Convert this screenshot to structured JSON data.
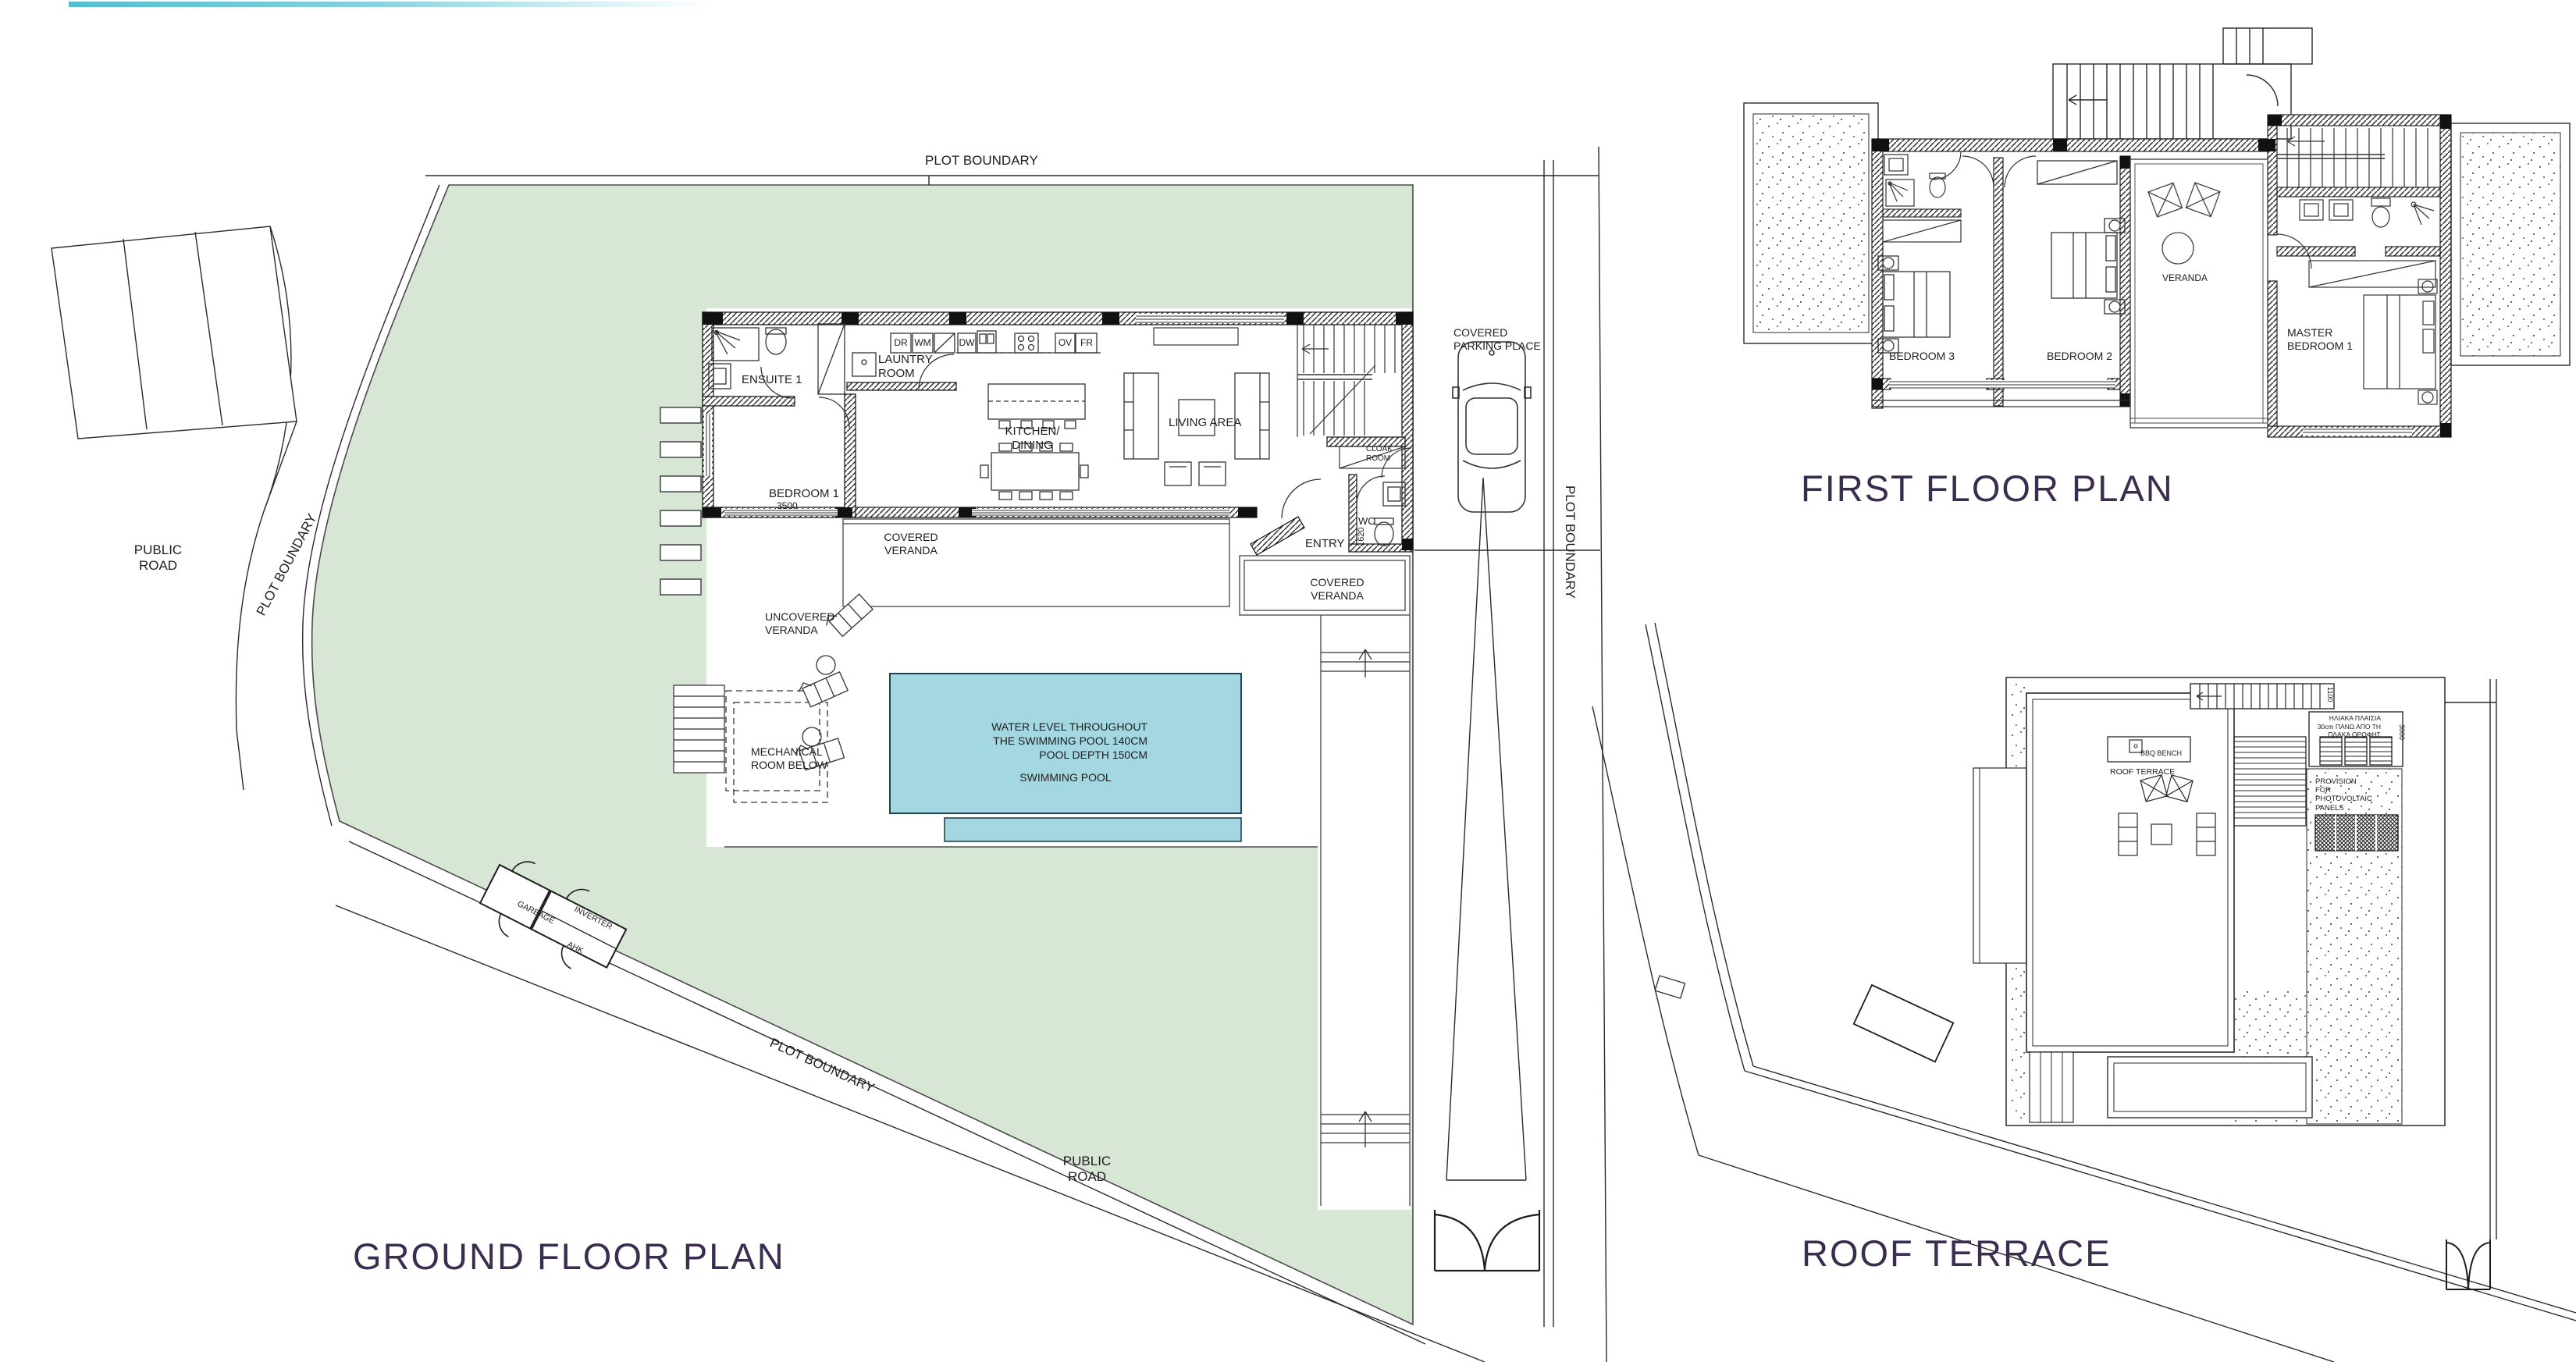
{
  "top_bar": {
    "color": "#54bfd0"
  },
  "titles": {
    "ground_floor": "GROUND FLOOR PLAN",
    "first_floor": "FIRST FLOOR PLAN",
    "roof_terrace": "ROOF TERRACE"
  },
  "site": {
    "plot_boundary": "PLOT BOUNDARY",
    "public_road": "PUBLIC ROAD"
  },
  "ground_floor": {
    "rooms": {
      "ensuite": "ENSUITE 1",
      "laundry": "LAUNTRY ROOM",
      "bedroom1": "BEDROOM 1",
      "bedroom1_dim": "3500",
      "kitchen_dining": "KITCHEN/ DINING",
      "living_area": "LIVING AREA",
      "cloak_room": "CLOAK ROOM",
      "wc": "WC",
      "wc_dim": "1620",
      "entry": "ENTRY",
      "covered_veranda": "COVERED VERANDA",
      "uncovered_veranda": "UNCOVERED VERANDA",
      "mechanical_room": "MECHANICAL ROOM BELOW",
      "covered_parking": "COVERED PARKING PLACE"
    },
    "appliances": {
      "dryer": "DR",
      "washing_machine": "WM",
      "dishwasher": "DW",
      "oven": "OV",
      "fridge": "FR"
    },
    "pool": {
      "note_line1": "WATER LEVEL THROUGHOUT",
      "note_line2": "THE SWIMMING POOL 140CM",
      "note_line3": "POOL DEPTH 150CM",
      "label": "SWIMMING POOL",
      "color": "#a3d7e2"
    },
    "outbuilding": {
      "garbage": "GARBAGE",
      "inverter": "INVERTER",
      "ahu": "AHK"
    }
  },
  "first_floor": {
    "rooms": {
      "bedroom3": "BEDROOM 3",
      "bedroom2": "BEDROOM 2",
      "veranda": "VERANDA",
      "master_bedroom": "MASTER BEDROOM 1"
    }
  },
  "roof_terrace": {
    "labels": {
      "bbq_bench": "BBQ BENCH",
      "roof_terrace": "ROOF TERRACE",
      "pv_provision": "PROVISION FOR PHOTOVOLTAIC PANELS"
    },
    "greek_note": {
      "line1": "ΗΛΙΑΚΑ ΠΛΑΙΣΙΑ",
      "line2": "30cm ΠΑΝΩ ΑΠΟ ΤΗ",
      "line3": "ΠΛΑΚΑ ΟΡΟΦΗΣ"
    },
    "dimensions": {
      "stair_width": "1100",
      "solar_height": "3000"
    }
  },
  "colors": {
    "plot_green": "#d7e6d5",
    "pool_blue": "#a3d7e2",
    "title": "#3b2d4f",
    "line": "#1d1d1d"
  }
}
